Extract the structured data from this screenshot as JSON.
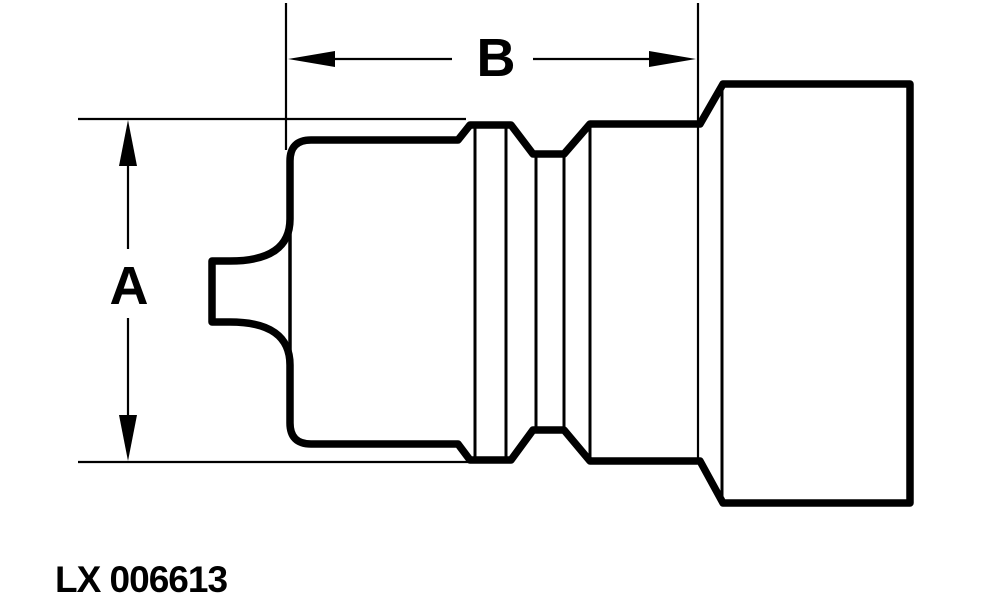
{
  "figure": {
    "type": "engineering-line-drawing",
    "subject": "coupling-half-side-view",
    "id_label": "LX 006613",
    "dimensions": {
      "a_label": "A",
      "b_label": "B"
    }
  },
  "colors": {
    "line": "#000000",
    "background": "#ffffff"
  }
}
